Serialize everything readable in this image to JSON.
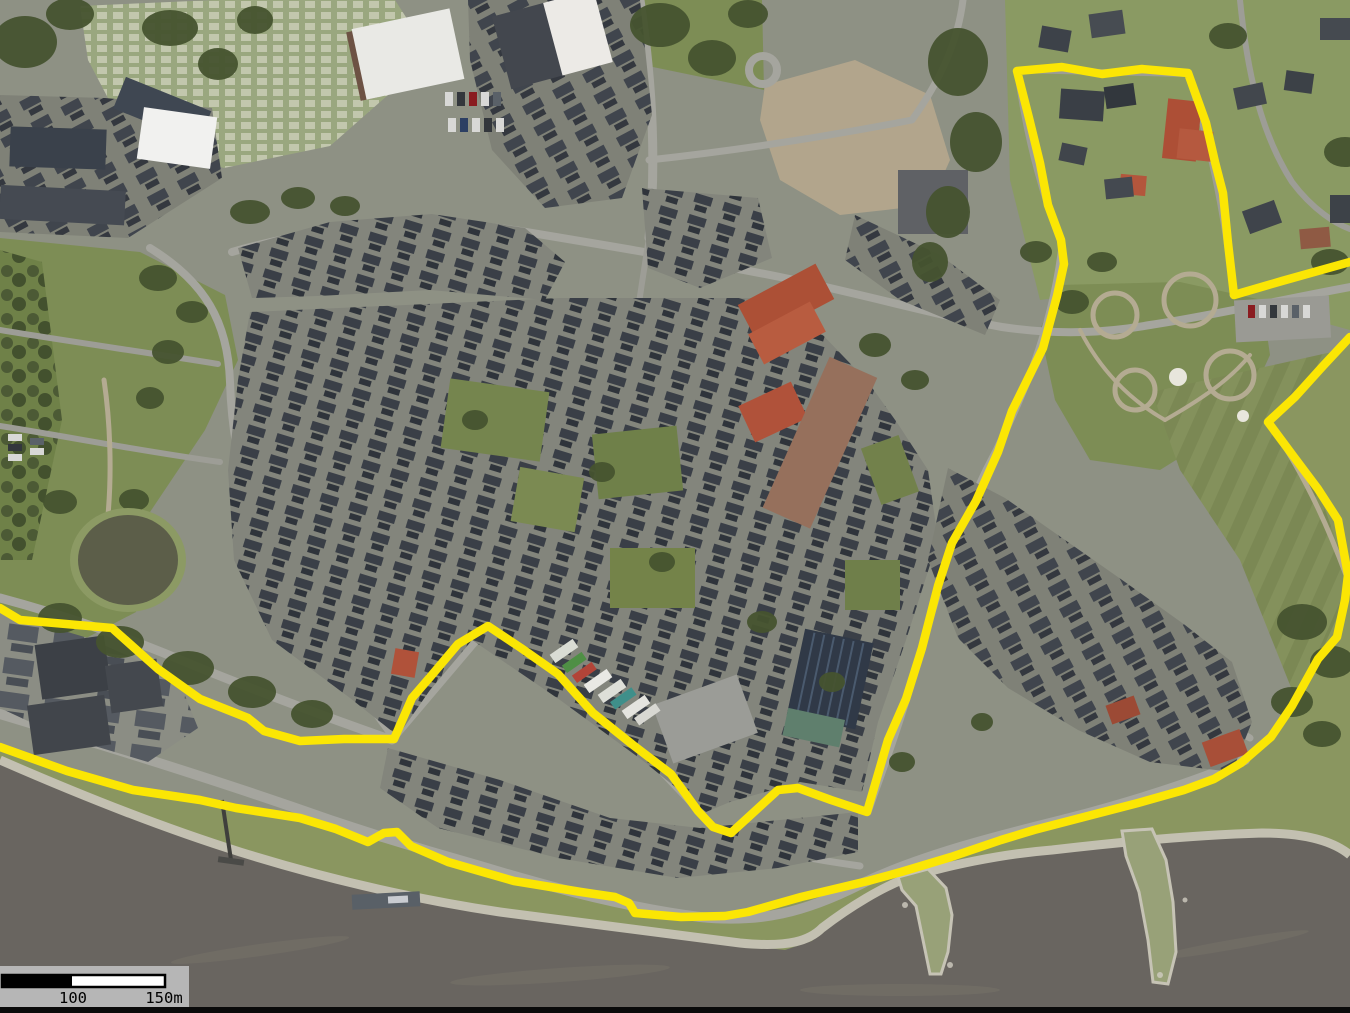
{
  "meta": {
    "kind": "aerial-imagery-map",
    "description": "Aerial orthophoto of a riverside town centre with a yellow project-boundary overlay",
    "canvas": {
      "width": 1350,
      "height": 1013
    }
  },
  "overlay": {
    "boundary_color": "#fbe604",
    "boundary_width": 8.5,
    "segments": [
      {
        "name": "inner-town-boundary",
        "points": "0,608 20,620 112,628 158,669 200,699 248,718 264,731 300,741 344,739 394,739 412,698 431,676 458,644 488,626 521,648 558,674 593,713 633,745 671,774 698,811 713,827 731,833 778,790 798,788 831,800 867,812 888,740 906,699 922,648 938,586 952,543 976,501 998,452 1012,411 1043,348 1057,296 1064,264 1061,240 1048,205 1040,163 1029,118 1017,71 1062,67 1102,74 1142,69 1188,73 1206,123 1215,162 1223,193 1228,243 1234,295 1282,281 1350,262"
      },
      {
        "name": "riverfront-boundary",
        "points": "0,747 67,771 133,790 200,800 236,808 300,818 336,829 368,842 384,833 397,832 411,846 448,862 514,881 581,892 615,897 629,903 635,913 681,917 725,916 748,912 801,897 868,881 901,872 951,857 1001,840 1034,830 1084,817 1138,803 1184,790 1214,779 1241,763 1271,737 1292,706 1318,659 1337,637 1345,600 1348,575 1338,520 1318,489 1294,457 1268,422 1295,397 1323,366 1350,337"
      }
    ]
  },
  "scale_bar": {
    "labels": {
      "mid": "100",
      "end": "150m"
    },
    "colors": {
      "panel": "#b6b6b6",
      "bar_fill": "#ffffff",
      "bar_segment": "#000000",
      "text": "#000000"
    }
  }
}
